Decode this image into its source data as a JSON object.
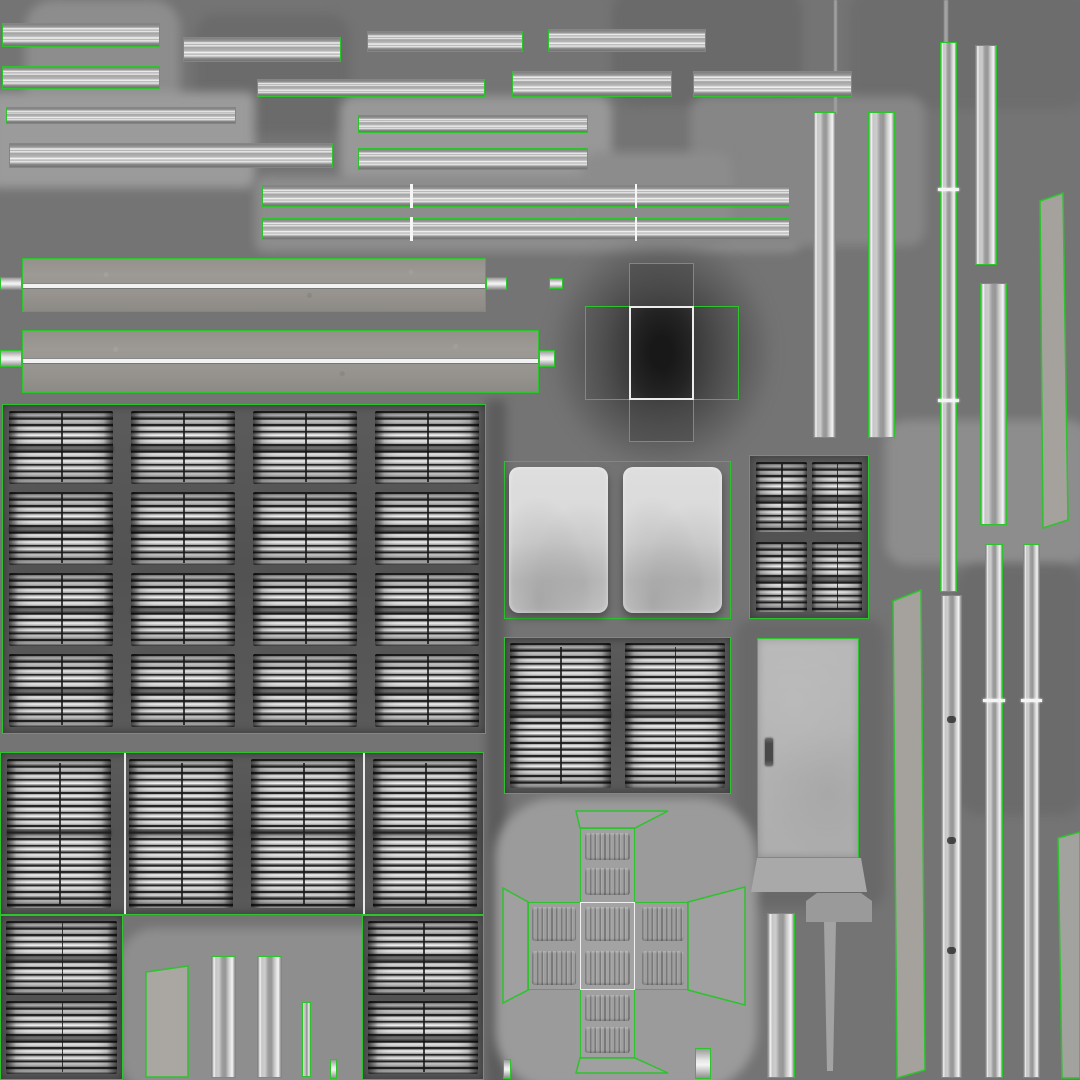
{
  "atlas": {
    "canvas": {
      "width": 1080,
      "height": 1080,
      "background": "#747474"
    },
    "colors": {
      "uv_outline_green": "#2cc32c",
      "background_base": "#747474",
      "rail_highlight": "#f5f5f5",
      "louver_dark": "#262626",
      "louver_light": "#dcdcdc",
      "beam_speckle": "#97938e",
      "dark_box_fill": "#1d1d1d",
      "door_fill": "#b5b5b5",
      "panel_fill": "#d8d8d8",
      "blob_light": "#9b9b9b",
      "blob_dark": "#3f3f3f"
    },
    "patches": [
      {
        "x": 25,
        "y": 0,
        "w": 155,
        "h": 160,
        "c": "#8d8d8d",
        "r": 28
      },
      {
        "x": 195,
        "y": 14,
        "w": 155,
        "h": 120,
        "c": "#6b6b6b",
        "r": 22
      },
      {
        "x": -10,
        "y": 92,
        "w": 265,
        "h": 96,
        "c": "#9b9b9b",
        "r": 8
      },
      {
        "x": 340,
        "y": 96,
        "w": 272,
        "h": 90,
        "c": "#989898",
        "r": 14
      },
      {
        "x": 255,
        "y": 176,
        "w": 545,
        "h": 76,
        "c": "#8d8d8d",
        "r": 10
      },
      {
        "x": 612,
        "y": -12,
        "w": 190,
        "h": 118,
        "c": "#6a6a6a",
        "r": 24
      },
      {
        "x": 850,
        "y": -12,
        "w": 240,
        "h": 120,
        "c": "#6d6d6d",
        "r": 24
      },
      {
        "x": 690,
        "y": 96,
        "w": 235,
        "h": 150,
        "c": "#868686",
        "r": 16
      },
      {
        "x": 486,
        "y": 400,
        "w": 20,
        "h": 690,
        "c": "#5c5c5c",
        "r": 4
      },
      {
        "x": 885,
        "y": 420,
        "w": 205,
        "h": 145,
        "c": "#8d8d8d",
        "r": 22
      },
      {
        "x": 735,
        "y": 618,
        "w": 150,
        "h": 290,
        "c": "#696969",
        "r": 20
      },
      {
        "x": 495,
        "y": 798,
        "w": 262,
        "h": 292,
        "c": "#9b9b9b",
        "r": 60
      },
      {
        "x": 120,
        "y": 928,
        "w": 295,
        "h": 165,
        "c": "#8e8e8e",
        "r": 34
      },
      {
        "x": 955,
        "y": 565,
        "w": 130,
        "h": 250,
        "c": "#6b6b6b",
        "r": 26
      },
      {
        "x": 582,
        "y": 152,
        "w": 150,
        "h": 80,
        "c": "#8c8c8c",
        "r": 16
      }
    ],
    "dark_blob": {
      "x": 548,
      "y": 232,
      "w": 228,
      "h": 240
    },
    "texture_lines": [
      {
        "x": 834,
        "y": 0,
        "w": 3,
        "h": 114,
        "c": "#9f9f9f"
      },
      {
        "x": 944,
        "y": 0,
        "w": 4,
        "h": 44,
        "c": "#a2a2a2"
      }
    ],
    "h_rails": [
      {
        "x": 2,
        "y": 23,
        "w": 158,
        "h": 24
      },
      {
        "x": 183,
        "y": 37,
        "w": 158,
        "h": 25
      },
      {
        "x": 367,
        "y": 31,
        "w": 156,
        "h": 21
      },
      {
        "x": 548,
        "y": 29,
        "w": 158,
        "h": 23
      },
      {
        "x": 2,
        "y": 66,
        "w": 158,
        "h": 23
      },
      {
        "x": 257,
        "y": 79,
        "w": 228,
        "h": 18
      },
      {
        "x": 512,
        "y": 71,
        "w": 160,
        "h": 26
      },
      {
        "x": 693,
        "y": 71,
        "w": 159,
        "h": 26
      },
      {
        "x": 6,
        "y": 107,
        "w": 230,
        "h": 17
      },
      {
        "x": 358,
        "y": 115,
        "w": 230,
        "h": 18
      },
      {
        "x": 9,
        "y": 143,
        "w": 324,
        "h": 25
      },
      {
        "x": 358,
        "y": 148,
        "w": 230,
        "h": 22
      },
      {
        "x": 262,
        "y": 185,
        "w": 528,
        "h": 22,
        "vticks": [
          0.28,
          0.707
        ]
      },
      {
        "x": 262,
        "y": 218,
        "w": 528,
        "h": 22,
        "vticks": [
          0.28,
          0.707
        ]
      }
    ],
    "beams": [
      {
        "x": 22,
        "y": 258,
        "w": 464,
        "h": 54,
        "line_frac": 0.47
      },
      {
        "x": 22,
        "y": 330,
        "w": 517,
        "h": 63,
        "line_frac": 0.44
      }
    ],
    "beam_tabs": [
      {
        "x": 0,
        "y": 277,
        "w": 22,
        "h": 13
      },
      {
        "x": 486,
        "y": 277,
        "w": 21,
        "h": 13
      },
      {
        "x": 549,
        "y": 278,
        "w": 14,
        "h": 11
      },
      {
        "x": 0,
        "y": 350,
        "w": 22,
        "h": 17
      },
      {
        "x": 539,
        "y": 350,
        "w": 16,
        "h": 17
      }
    ],
    "v_rails": [
      {
        "x": 813,
        "y": 112,
        "w": 23,
        "h": 326
      },
      {
        "x": 868,
        "y": 112,
        "w": 27,
        "h": 326
      },
      {
        "x": 940,
        "y": 42,
        "w": 17,
        "h": 550,
        "ticks": [
          0.265,
          0.65
        ]
      },
      {
        "x": 975,
        "y": 45,
        "w": 22,
        "h": 220
      },
      {
        "x": 980,
        "y": 283,
        "w": 27,
        "h": 242
      },
      {
        "x": 941,
        "y": 595,
        "w": 21,
        "h": 483,
        "marks": [
          0.25,
          0.5,
          0.73
        ]
      },
      {
        "x": 985,
        "y": 544,
        "w": 18,
        "h": 534,
        "ticks": [
          0.29
        ]
      },
      {
        "x": 1023,
        "y": 544,
        "w": 17,
        "h": 534,
        "ticks": [
          0.29
        ]
      },
      {
        "x": 767,
        "y": 913,
        "w": 28,
        "h": 165
      },
      {
        "x": 302,
        "y": 1002,
        "w": 9,
        "h": 75
      },
      {
        "x": 257,
        "y": 956,
        "w": 25,
        "h": 122
      },
      {
        "x": 211,
        "y": 956,
        "w": 25,
        "h": 122
      }
    ],
    "speckle_polys": [
      {
        "name": "speckle-strip-right-upper",
        "points": "1040,201 1063,193 1068,520 1043,528",
        "fill": "#a5a29d"
      },
      {
        "name": "speckle-strip-right-lower",
        "points": "893,601 921,590 925,1070 897,1078",
        "fill": "#a5a29d"
      },
      {
        "name": "speckle-strip-bottom-left",
        "points": "146,972 188,966 188,1077 146,1077",
        "fill": "#aaa7a2"
      },
      {
        "name": "speckle-strip-right-corner",
        "points": "1058,838 1080,832 1080,1078 1062,1078",
        "fill": "#a2a29e"
      }
    ],
    "grids": [
      {
        "x": 2,
        "y": 404,
        "w": 484,
        "h": 330,
        "cols": 4,
        "rows": 4,
        "cgap": 18,
        "rgap": 8,
        "pad": 6
      },
      {
        "x": 0,
        "y": 752,
        "w": 484,
        "h": 163,
        "cols": 4,
        "rows": 1,
        "cgap": 18,
        "rgap": 0,
        "pad": 6,
        "seams_x": [
          123,
          362
        ]
      },
      {
        "x": 0,
        "y": 915,
        "w": 123,
        "h": 165,
        "cols": 1,
        "rows": 2,
        "cgap": 0,
        "rgap": 6,
        "pad": 5
      },
      {
        "x": 362,
        "y": 915,
        "w": 122,
        "h": 165,
        "cols": 1,
        "rows": 2,
        "cgap": 0,
        "rgap": 6,
        "pad": 5
      },
      {
        "x": 504,
        "y": 637,
        "w": 227,
        "h": 157,
        "cols": 2,
        "rows": 1,
        "cgap": 14,
        "rgap": 0,
        "pad": 5
      },
      {
        "x": 749,
        "y": 455,
        "w": 120,
        "h": 164,
        "cols": 2,
        "rows": 2,
        "cgap": 5,
        "rgap": 10,
        "pad": 6
      }
    ],
    "white_panel_group": {
      "box": {
        "x": 504,
        "y": 461,
        "w": 227,
        "h": 158
      },
      "panels": [
        {
          "x": 4,
          "y": 5,
          "w": 99,
          "h": 146
        },
        {
          "x": 118,
          "y": 5,
          "w": 99,
          "h": 146
        }
      ]
    },
    "door": {
      "x": 757,
      "y": 638,
      "w": 102,
      "h": 220,
      "handle": {
        "x": 7,
        "y": 99,
        "w": 8,
        "h": 28
      }
    },
    "box_unwrap": {
      "h_rect": {
        "x": 585,
        "y": 306,
        "w": 154,
        "h": 94
      },
      "v_rect": {
        "x": 629,
        "y": 263,
        "w": 65,
        "h": 179
      },
      "center": {
        "x": 629,
        "y": 306,
        "w": 65,
        "h": 94
      }
    },
    "cross_unwrap": {
      "v_rect": {
        "x": 580,
        "y": 828,
        "w": 55,
        "h": 230
      },
      "h_rect": {
        "x": 528,
        "y": 902,
        "w": 160,
        "h": 88
      },
      "center_seam": {
        "x": 580,
        "y": 902,
        "w": 55,
        "h": 88
      },
      "flaps": [
        {
          "name": "cross-flap-top",
          "points": "576,811 668,811 635,828 580,828"
        },
        {
          "name": "cross-flap-bottom",
          "points": "580,1058 635,1058 668,1073 576,1073"
        },
        {
          "name": "cross-flap-left",
          "points": "528,902 528,990 503,1003 503,888"
        },
        {
          "name": "cross-flap-right",
          "points": "688,902 745,887 745,1005 688,990"
        }
      ],
      "vents": [
        {
          "x": 585,
          "y": 833,
          "w": 45,
          "h": 62
        },
        {
          "x": 585,
          "y": 907,
          "w": 45,
          "h": 78
        },
        {
          "x": 585,
          "y": 995,
          "w": 45,
          "h": 58
        },
        {
          "x": 532,
          "y": 907,
          "w": 44,
          "h": 78
        },
        {
          "x": 642,
          "y": 907,
          "w": 42,
          "h": 78
        }
      ]
    },
    "mast": {
      "cap_points": "806,901 817,893 861,893 872,901 872,922 806,922",
      "stick_points": "824,922 836,922 833,1071 827,1071",
      "apron_points": "757,858 861,858 867,892 751,892"
    },
    "small_bits": [
      {
        "x": 330,
        "y": 1059,
        "w": 7,
        "h": 20
      },
      {
        "x": 503,
        "y": 1059,
        "w": 8,
        "h": 20
      },
      {
        "x": 695,
        "y": 1048,
        "w": 16,
        "h": 31
      }
    ]
  }
}
